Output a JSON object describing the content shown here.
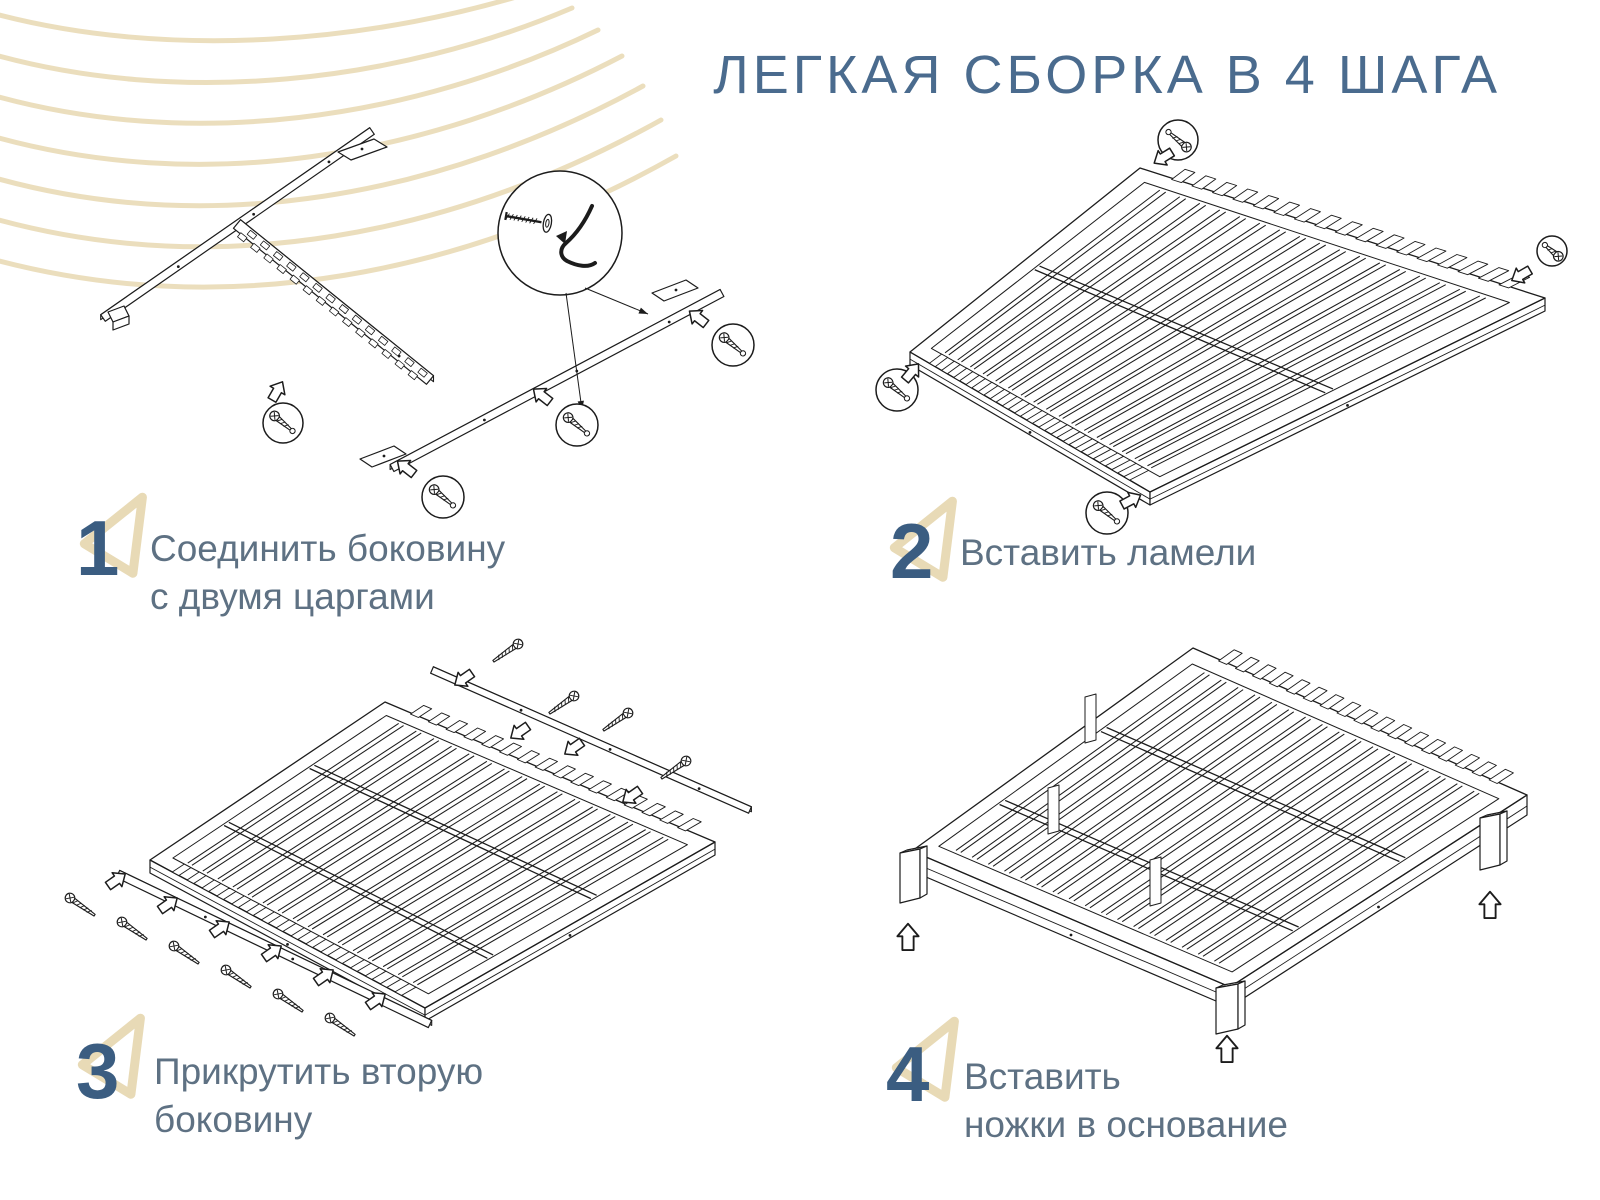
{
  "title": "ЛЕГКАЯ СБОРКА В 4 ШАГА",
  "steps": [
    {
      "number": "1",
      "lines": [
        "Соединить боковину",
        "с двумя царгами"
      ],
      "illustration": "side-rail-and-two-frame-rails-with-screws"
    },
    {
      "number": "2",
      "lines": [
        "Вставить ламели"
      ],
      "illustration": "slat-base-with-four-corner-screws"
    },
    {
      "number": "3",
      "lines": [
        "Прикрутить вторую",
        "боковину"
      ],
      "illustration": "slat-base-with-detached-side-rails-and-screws"
    },
    {
      "number": "4",
      "lines": [
        "Вставить",
        "ножки в основание"
      ],
      "illustration": "slat-base-on-legs-with-insert-arrows"
    }
  ],
  "colors": {
    "title_blue": "#4a6b8e",
    "number_blue": "#3b5d81",
    "text_gray_blue": "#5e7183",
    "decor_tan": "#eadcb9",
    "line_art": "#1c1c1c",
    "background": "#ffffff"
  }
}
